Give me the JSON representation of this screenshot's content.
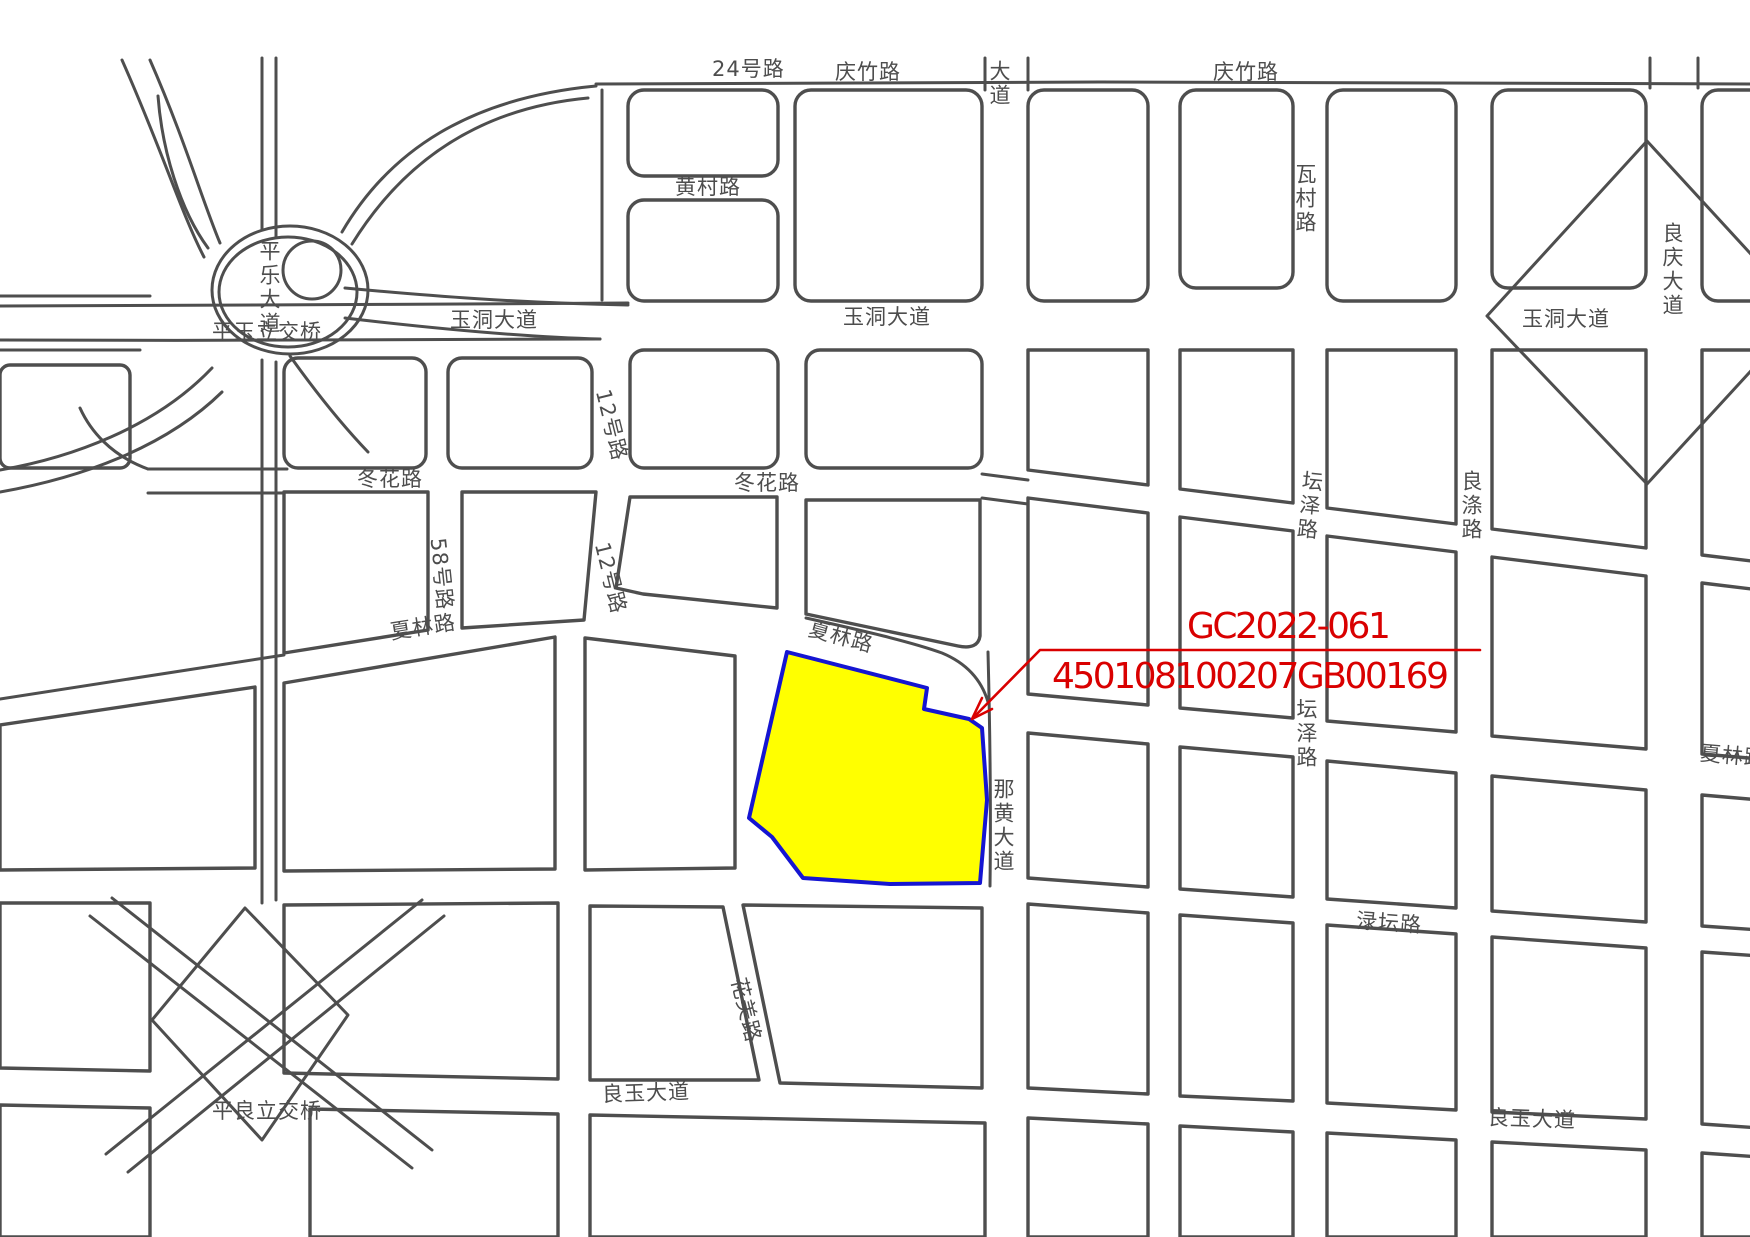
{
  "map": {
    "colors": {
      "background": "#FFFFFF",
      "road": "#4E4E4E",
      "label": "#4D4D4D",
      "annotation": "#D90000",
      "parcel_fill": "#FFFF00",
      "parcel_outline": "#1515D2"
    },
    "parcel": {
      "project_code": "GC2022-061",
      "certificate_code": "450108100207GB00169"
    },
    "annotation": {
      "line1": "GC2022-061",
      "line2": "450108100207GB00169"
    },
    "road_labels": [
      {
        "text": "大道"
      },
      {
        "text": "24号路"
      },
      {
        "text": "庆竹路"
      },
      {
        "text": "庆竹路"
      },
      {
        "text": "黄村路"
      },
      {
        "text": "瓦村路"
      },
      {
        "text": "玉洞大道"
      },
      {
        "text": "玉洞大道"
      },
      {
        "text": "玉洞大道"
      },
      {
        "text": "良庆大道"
      },
      {
        "text": "平乐大道"
      },
      {
        "text": "平玉立交桥"
      },
      {
        "text": "冬花路"
      },
      {
        "text": "冬花路"
      },
      {
        "text": "12号路"
      },
      {
        "text": "12号路"
      },
      {
        "text": "58号路"
      },
      {
        "text": "夏林路"
      },
      {
        "text": "夏林路"
      },
      {
        "text": "坛泽路"
      },
      {
        "text": "良涤路"
      },
      {
        "text": "那黄大道"
      },
      {
        "text": "坛泽路"
      },
      {
        "text": "渌坛路"
      },
      {
        "text": "花美路"
      },
      {
        "text": "良玉大道"
      },
      {
        "text": "良玉大道"
      },
      {
        "text": "平良立交桥"
      },
      {
        "text": "夏林路"
      }
    ]
  }
}
